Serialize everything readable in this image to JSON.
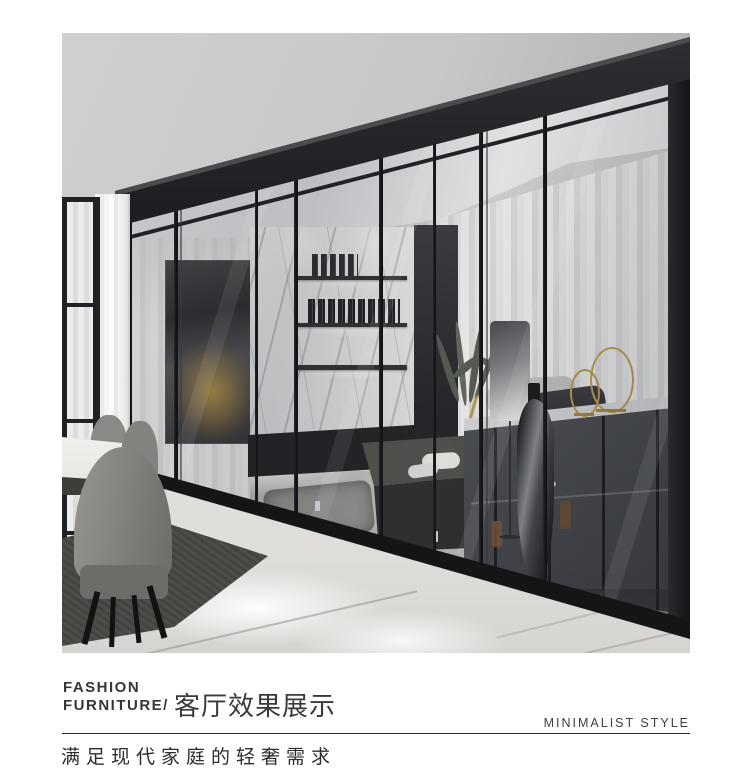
{
  "brand": {
    "line1": "FASHION",
    "line2": "FURNITURE/"
  },
  "caption": {
    "title": "客厅效果展示",
    "style_label": "MINIMALIST STYLE",
    "subtitle": "满足现代家庭的轻奢需求"
  },
  "colors": {
    "page_bg": "#ffffff",
    "text_primary": "#333336",
    "divider_line": "#2b2b2b",
    "partition_frame_black": "#17181a",
    "gold_accent": "#c49c4e",
    "marble_floor": "#e8e6e2"
  }
}
